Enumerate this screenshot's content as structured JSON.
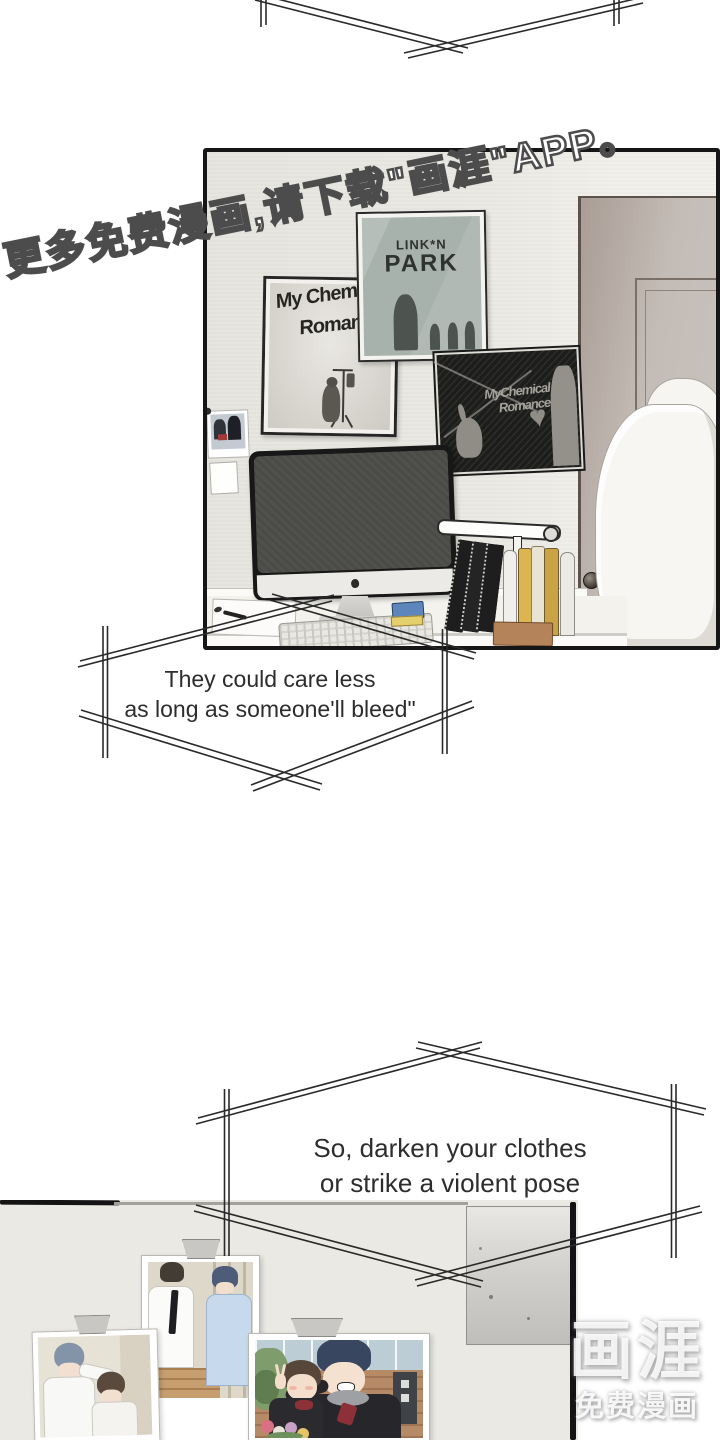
{
  "page": {
    "watermark": "更多免费漫画,请下载\"画涯\"APP。"
  },
  "bubbles": {
    "b1": {
      "line1": "They could care less",
      "line2": "as long as someone'll bleed\""
    },
    "b2": {
      "line1": "So, darken your clothes",
      "line2": "or strike a violent pose"
    }
  },
  "panel1": {
    "posters": {
      "linkin_park": {
        "title1": "LINK*N",
        "title2": "PARK"
      },
      "mcr_white": {
        "line1": "My Chemical",
        "line2": "Romance"
      },
      "mcr_black": {
        "line1": "MyChemical",
        "line2": "Romance",
        "heart_glyph": "♥"
      }
    }
  },
  "logo": {
    "brand": "画涯",
    "tagline": "免费漫画"
  },
  "colors": {
    "wall1": "#e9e7e1",
    "wall2": "#ebe9e3",
    "poster-lp": "#a8b2ac",
    "poster-dark": "#1d1d1c",
    "door": "#c2bab3",
    "ink": "#1c1c1c",
    "bubble-text": "#2d2d2d",
    "accent-blue": "#5d86bd",
    "sticky-yellow": "#e5cf6d",
    "book-yellow": "#dcb451",
    "wood": "#b5835a"
  }
}
